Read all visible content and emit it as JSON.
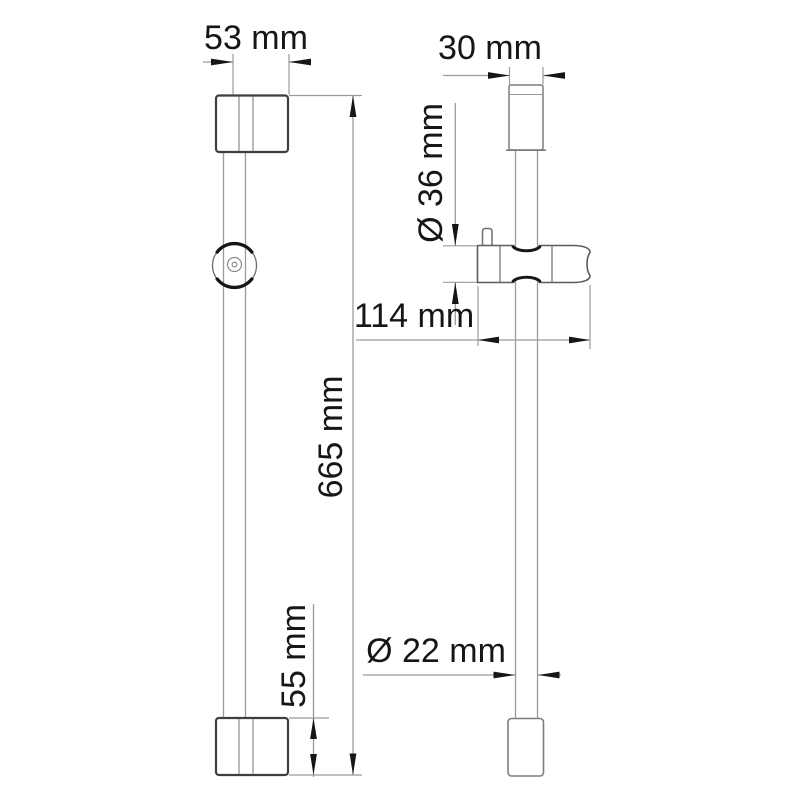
{
  "drawing": {
    "kind": "technical dimension drawing, two orthographic views of a shower slide bar",
    "background_color": "#ffffff",
    "line_color": "#9b9b9b",
    "outline_color": "#3f3f3f",
    "arrow_color": "#161616",
    "text_color": "#161616"
  },
  "labels": {
    "top_bracket_width": "53 mm",
    "top_cap_width": "30 mm",
    "holder_diameter": "Ø 36 mm",
    "holder_length": "114 mm",
    "bar_length": "665 mm",
    "bracket_height": "55 mm",
    "tube_diameter": "Ø 22 mm"
  },
  "measurements": [
    {
      "label": "53 mm",
      "value_mm": 53,
      "orientation": "horizontal",
      "span": "top wall bracket width (front view)"
    },
    {
      "label": "30 mm",
      "value_mm": 30,
      "orientation": "horizontal",
      "span": "top wall bracket width (side view)"
    },
    {
      "label": "Ø 36 mm",
      "value_mm": 36,
      "orientation": "vertical",
      "span": "sliding holder body diameter"
    },
    {
      "label": "114 mm",
      "value_mm": 114,
      "orientation": "horizontal",
      "span": "sliding holder overall length"
    },
    {
      "label": "665 mm",
      "value_mm": 665,
      "orientation": "vertical",
      "span": "overall bar length"
    },
    {
      "label": "55 mm",
      "value_mm": 55,
      "orientation": "vertical",
      "span": "bottom wall bracket height"
    },
    {
      "label": "Ø 22 mm",
      "value_mm": 22,
      "orientation": "horizontal",
      "span": "bar tube diameter"
    }
  ]
}
